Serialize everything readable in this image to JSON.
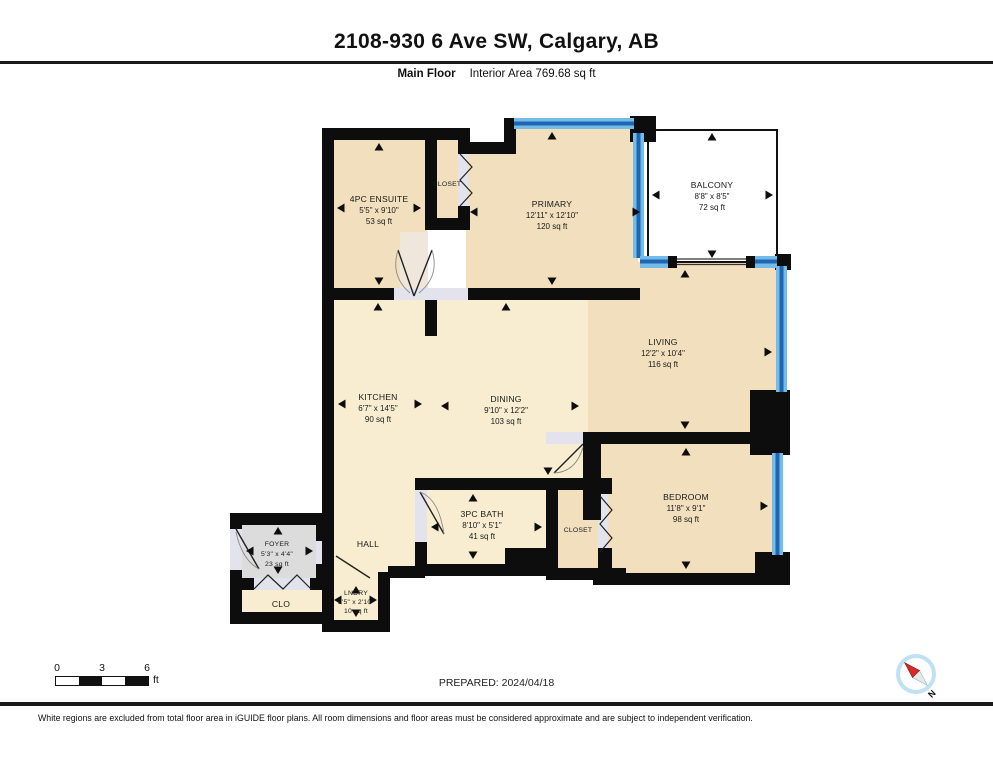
{
  "header": {
    "title": "2108-930 6 Ave SW, Calgary, AB",
    "floor_label": "Main Floor",
    "interior_area": "Interior Area 769.68 sq ft"
  },
  "rooms": {
    "ensuite": {
      "name": "4PC ENSUITE",
      "dims": "5'5\" x 9'10\"",
      "area": "53 sq ft"
    },
    "closet_primary": {
      "name": "CLOSET"
    },
    "primary": {
      "name": "PRIMARY",
      "dims": "12'11\" x 12'10\"",
      "area": "120 sq ft"
    },
    "balcony": {
      "name": "BALCONY",
      "dims": "8'8\" x 8'5\"",
      "area": "72 sq ft"
    },
    "living": {
      "name": "LIVING",
      "dims": "12'2\" x 10'4\"",
      "area": "116 sq ft"
    },
    "kitchen": {
      "name": "KITCHEN",
      "dims": "6'7\" x 14'5\"",
      "area": "90 sq ft"
    },
    "dining": {
      "name": "DINING",
      "dims": "9'10\" x 12'2\"",
      "area": "103 sq ft"
    },
    "bedroom": {
      "name": "BEDROOM",
      "dims": "11'8\" x 9'1\"",
      "area": "98 sq ft"
    },
    "bath": {
      "name": "3PC BATH",
      "dims": "8'10\" x 5'1\"",
      "area": "41 sq ft"
    },
    "closet_bedroom": {
      "name": "CLOSET"
    },
    "foyer": {
      "name": "FOYER",
      "dims": "5'3\" x 4'4\"",
      "area": "23 sq ft"
    },
    "hall": {
      "name": "HALL"
    },
    "clo": {
      "name": "CLO"
    },
    "lndry": {
      "name": "LNDRY",
      "dims": "3'5\" x 2'10\"",
      "area": "10 sq ft"
    }
  },
  "footer": {
    "scale": {
      "tick0": "0",
      "tick1": "3",
      "tick2": "6",
      "unit": "ft"
    },
    "prepared": "PREPARED: 2024/04/18",
    "compass_label": "N",
    "disclaimer": "White regions are excluded from total floor area in iGUIDE floor plans. All room dimensions and floor areas must be considered approximate and are subject to independent verification."
  },
  "colors": {
    "wall": "#0d0d0d",
    "room_warm": "#f2dfbd",
    "room_light": "#f8edd0",
    "foyer_gray": "#dcdcdc",
    "threshold": "#e3e3ed",
    "window_light": "#74bbe8",
    "window_dark": "#1f66b0",
    "balcony_white": "#ffffff",
    "compass_blue": "#bfe1f2",
    "compass_red": "#d42a2a"
  }
}
